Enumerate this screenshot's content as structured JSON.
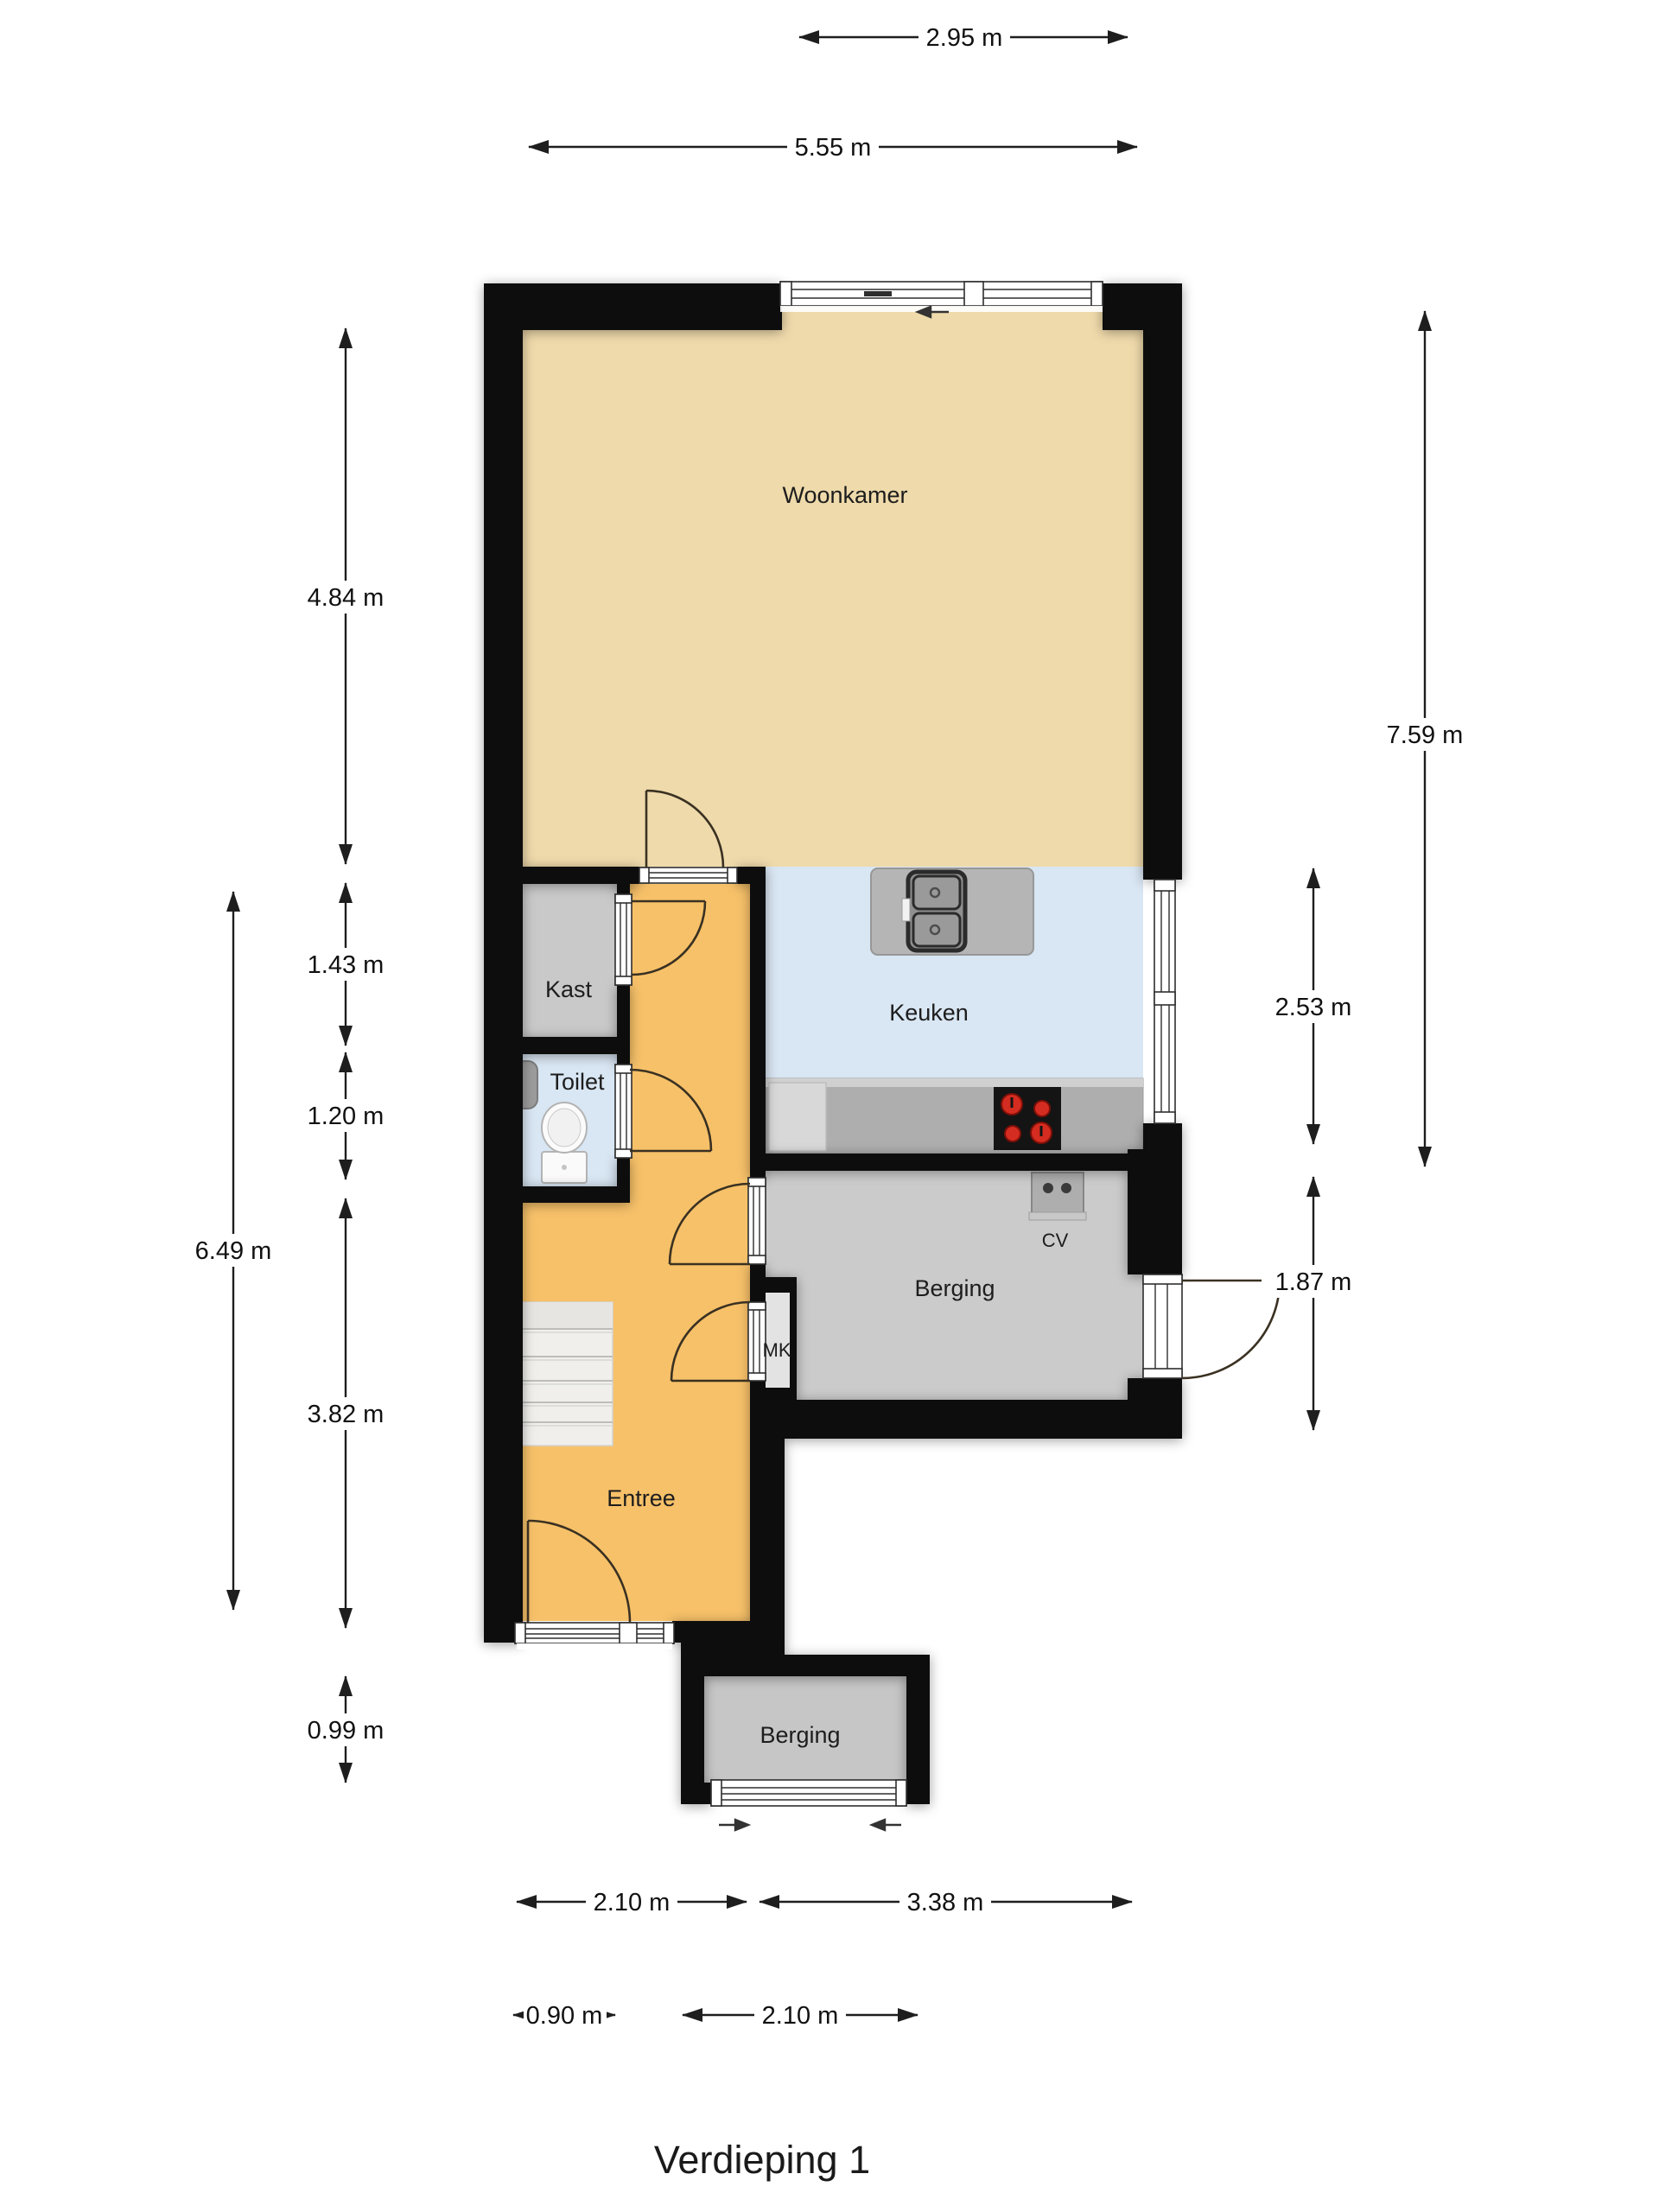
{
  "title": "Verdieping 1",
  "floor_plan": {
    "rooms": {
      "woonkamer": {
        "label": "Woonkamer"
      },
      "keuken": {
        "label": "Keuken"
      },
      "kast": {
        "label": "Kast"
      },
      "toilet": {
        "label": "Toilet"
      },
      "berging": {
        "label": "Berging"
      },
      "mk": {
        "label": "MK"
      },
      "entree": {
        "label": "Entree"
      },
      "berging_exterior": {
        "label": "Berging"
      }
    },
    "fixtures": {
      "cv": {
        "label": "CV"
      }
    },
    "dimensions": {
      "top": [
        {
          "label": "2.95 m"
        },
        {
          "label": "5.55 m"
        }
      ],
      "left": [
        {
          "label": "4.84 m"
        },
        {
          "label": "1.43 m"
        },
        {
          "label": "1.20 m"
        },
        {
          "label": "3.82 m"
        },
        {
          "label": "0.99 m"
        },
        {
          "label": "6.49 m"
        }
      ],
      "right": [
        {
          "label": "7.59 m"
        },
        {
          "label": "2.53 m"
        },
        {
          "label": "1.87 m"
        }
      ],
      "bottom": [
        {
          "label": "2.10 m"
        },
        {
          "label": "3.38 m"
        },
        {
          "label": "0.90 m"
        },
        {
          "label": "2.10 m"
        }
      ]
    },
    "colors": {
      "wall": "#0c0c0c",
      "floor_living": "#efdaab",
      "floor_entry": "#f7c169",
      "floor_kitchen": "#d9e6f3",
      "floor_storage": "#cbcbcb",
      "counter": "#b0b0b0",
      "burner_red": "#d42c20"
    }
  }
}
